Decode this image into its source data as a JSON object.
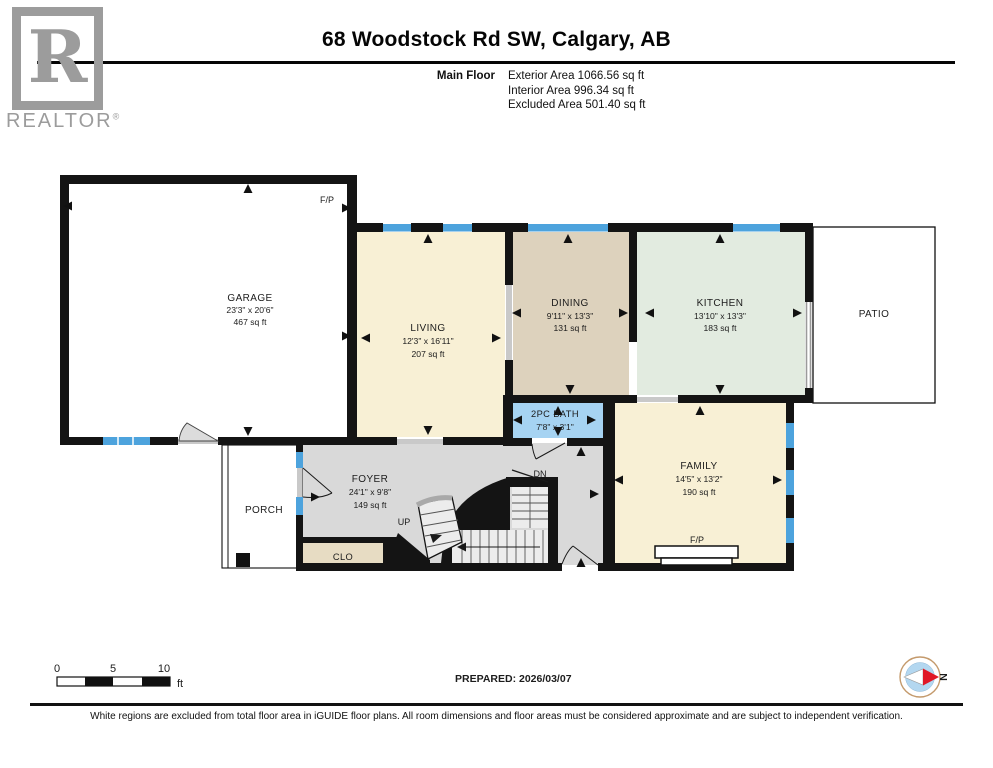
{
  "header": {
    "title": "68 Woodstock Rd SW, Calgary, AB",
    "floor_label": "Main Floor",
    "areas": {
      "exterior": "Exterior Area 1066.56 sq ft",
      "interior": "Interior Area 996.34 sq ft",
      "excluded": "Excluded Area 501.40 sq ft"
    }
  },
  "logo": {
    "letter": "R",
    "brand": "REALTOR",
    "registered": "®"
  },
  "rooms": {
    "garage": {
      "name": "GARAGE",
      "dims": "23'3\" x 20'6\"",
      "area": "467 sq ft"
    },
    "living": {
      "name": "LIVING",
      "dims": "12'3\" x 16'11\"",
      "area": "207 sq ft"
    },
    "dining": {
      "name": "DINING",
      "dims": "9'11\" x 13'3\"",
      "area": "131 sq ft"
    },
    "kitchen": {
      "name": "KITCHEN",
      "dims": "13'10\" x 13'3\"",
      "area": "183 sq ft"
    },
    "bath": {
      "name": "2PC BATH",
      "dims": "7'8\" x 3'1\""
    },
    "family": {
      "name": "FAMILY",
      "dims": "14'5\" x 13'2\"",
      "area": "190 sq ft"
    },
    "foyer": {
      "name": "FOYER",
      "dims": "24'1\" x 9'8\"",
      "area": "149 sq ft"
    },
    "patio": {
      "name": "PATIO"
    },
    "porch": {
      "name": "PORCH"
    },
    "closet": {
      "name": "CLO"
    }
  },
  "labels": {
    "fp": "F/P",
    "up": "UP",
    "dn": "DN",
    "north": "N"
  },
  "scalebar": {
    "t0": "0",
    "t5": "5",
    "t10": "10",
    "unit": "ft"
  },
  "footer": {
    "prepared": "PREPARED: 2026/03/07",
    "disclaimer": "White regions are excluded from total floor area in iGUIDE floor plans. All room dimensions and floor areas must be considered approximate and are subject to independent verification."
  },
  "colors": {
    "wall": "#141414",
    "window": "#4da3dd",
    "living": "#f8f0d5",
    "dining": "#ddd2bd",
    "kitchen": "#e2ebe0",
    "bath": "#a6d3f2",
    "hall": "#d9d9d9",
    "closet": "#e7dcc3",
    "stair": "#ececec",
    "opening": "#c9c9c9"
  }
}
